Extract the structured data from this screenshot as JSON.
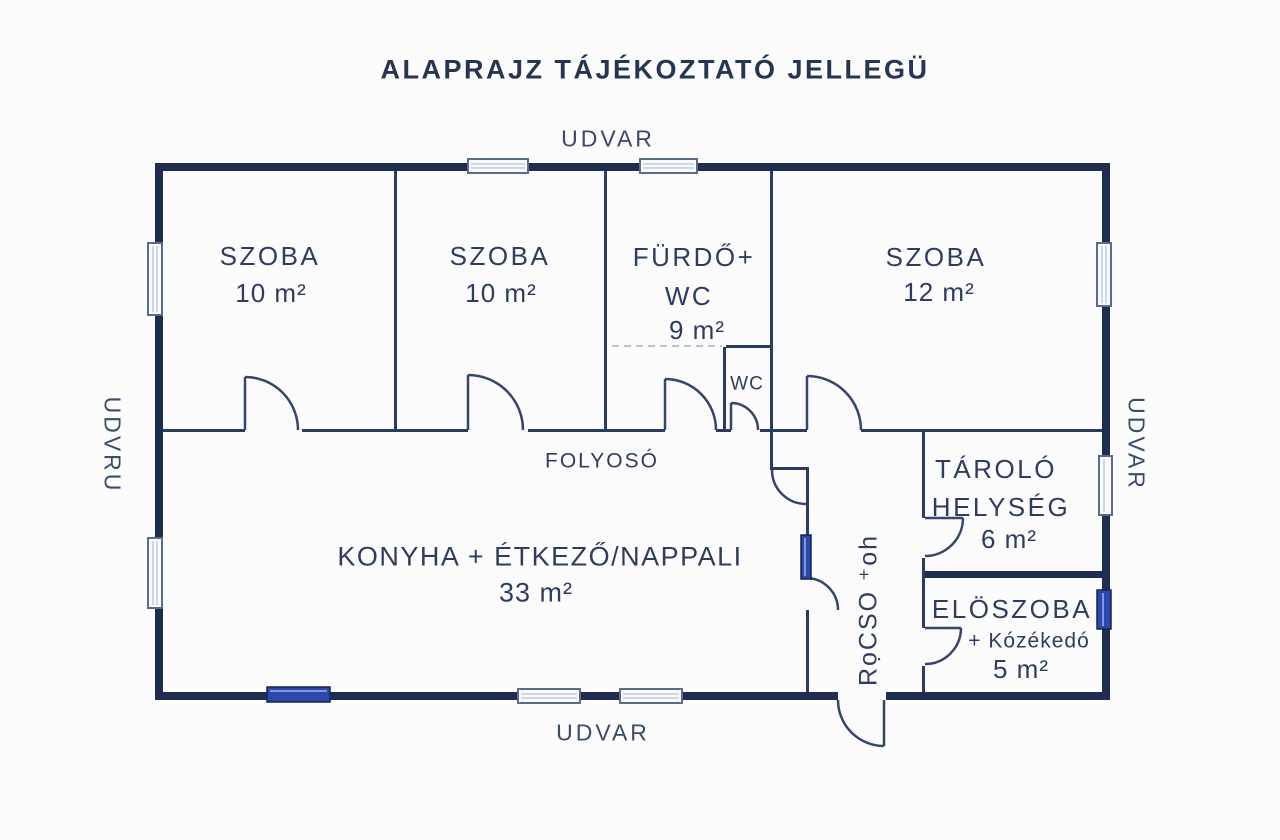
{
  "title": "ALAPRAJZ TÁJÉKOZTATÓ JELLEGÜ",
  "surroundings": {
    "top": "UDVAR",
    "bottom": "UDVAR",
    "left": "UDVRU",
    "right": "UDVAR"
  },
  "rooms": {
    "szoba1": {
      "name": "SZOBA",
      "area": "10 m²"
    },
    "szoba2": {
      "name": "SZOBA",
      "area": "10 m²"
    },
    "furdo": {
      "name_line1": "FÜRDŐ+",
      "name_line2": "WC",
      "area": "9 m²"
    },
    "szoba3": {
      "name": "SZOBA",
      "area": "12 m²"
    },
    "wc": {
      "name": "WC"
    },
    "folyoso": {
      "name": "FOLYOSÓ"
    },
    "konyha": {
      "name": "KONYHA + ÉTKEZŐ/NAPPALI",
      "area": "33 m²"
    },
    "tarolo": {
      "name_line1": "TÁROLÓ",
      "name_line2": "HELYSÉG",
      "area": "6 m²"
    },
    "eloszoba": {
      "name": "ELÖSZOBA",
      "sub": "+ Kózékedó",
      "area": "5 m²"
    },
    "passage": {
      "name": "RọCSO ⁺oh"
    }
  },
  "colors": {
    "wall": "#1e2d50",
    "wall_thin": "#2c3c60",
    "text": "#2e3d5f",
    "accent_blue": "#2a48ad",
    "window_fill": "#f8fafc"
  }
}
